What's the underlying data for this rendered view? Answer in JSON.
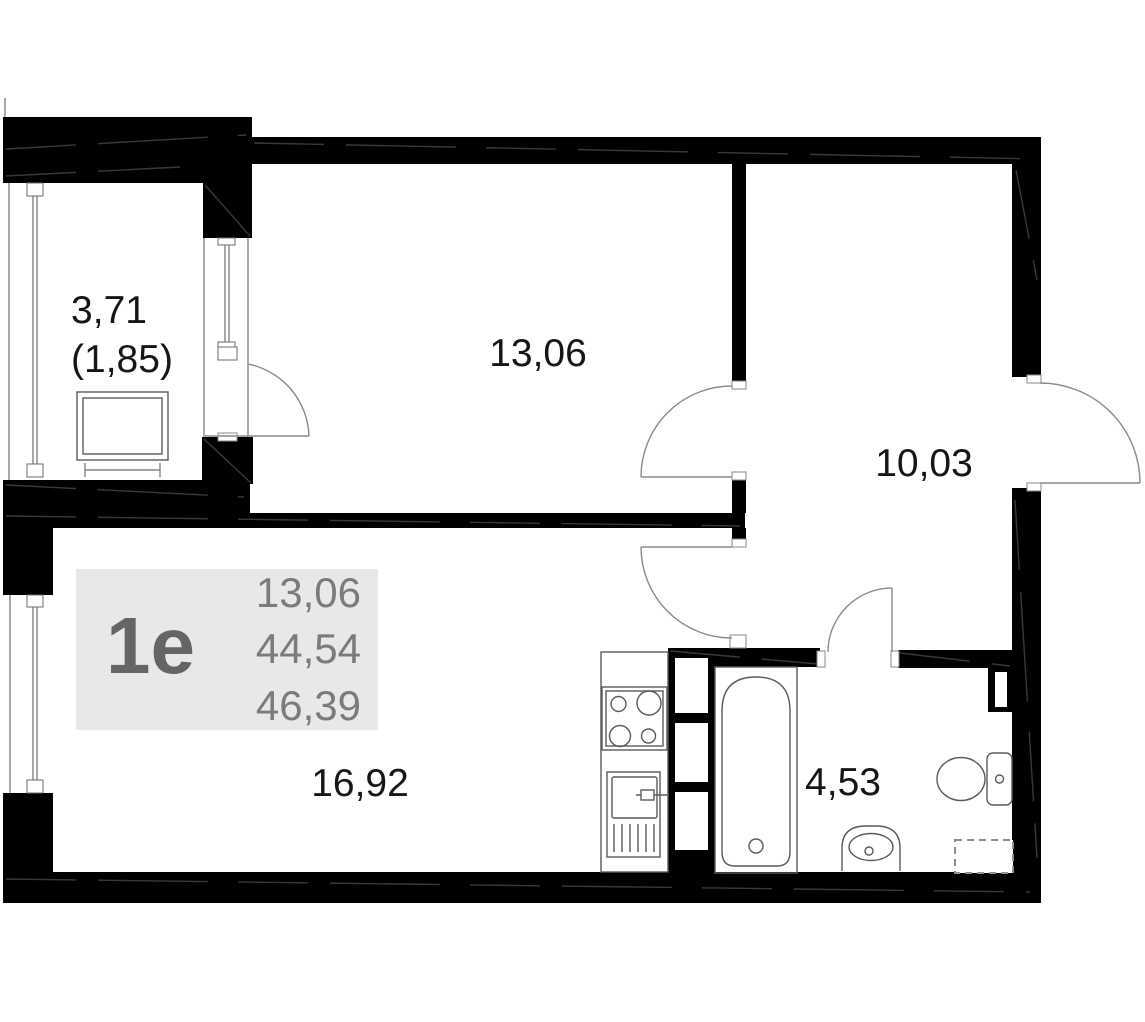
{
  "plan": {
    "unit_label": "1е",
    "info_values": [
      "13,06",
      "44,54",
      "46,39"
    ],
    "rooms": [
      {
        "name": "loggia",
        "area": "3,71",
        "area_reduced": "(1,85)"
      },
      {
        "name": "room",
        "area": "13,06"
      },
      {
        "name": "hallway",
        "area": "10,03"
      },
      {
        "name": "kitchen-living-room",
        "area": "16,92"
      },
      {
        "name": "bathroom",
        "area": "4,53"
      }
    ],
    "colors": {
      "wall": "#000000",
      "line": "#6e6e6e",
      "door": "#8a8a8a",
      "fixture": "#5a5a5a",
      "label": "#161616",
      "info_bg": "#e8e8e6",
      "info_text": "#7b7b7b",
      "unit_text": "#656565",
      "seam": "#383838"
    }
  }
}
